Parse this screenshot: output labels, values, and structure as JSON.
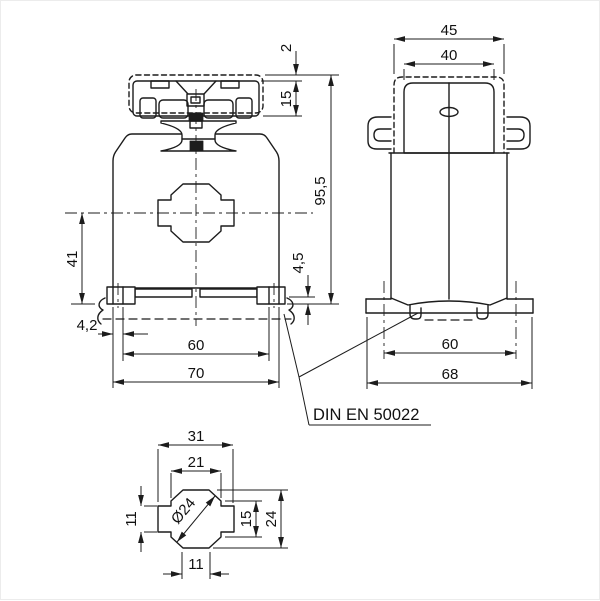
{
  "drawing": {
    "note": {
      "standard": "DIN EN 50022"
    },
    "front_view": {
      "dims": {
        "cover_protrusion": "2",
        "terminal_height": "15",
        "overall_height": "95,5",
        "center_to_base": "41",
        "rail_seat_depth": "4,5",
        "slot_width": "4,2",
        "rail_clip_span": "60",
        "overall_width": "70"
      }
    },
    "side_view": {
      "dims": {
        "cover_width": "45",
        "cap_width": "40",
        "rail_clip_span": "60",
        "base_width": "68"
      }
    },
    "detail_view": {
      "dims": {
        "outer_width": "31",
        "upper_width": "21",
        "bore_diameter": "Ø24",
        "band_height": "11",
        "inner_height": "15",
        "outer_height": "24",
        "tab_width": "11"
      }
    }
  }
}
